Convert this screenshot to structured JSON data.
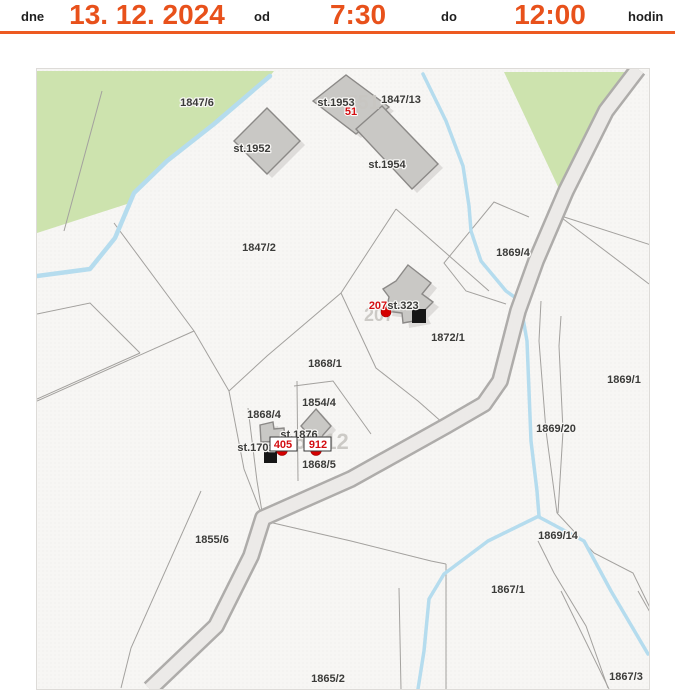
{
  "header": {
    "dne_label": "dne",
    "date": "13. 12. 2024",
    "od_label": "od",
    "time_from": "7:30",
    "do_label": "do",
    "time_to": "12:00",
    "hodin_label": "hodin"
  },
  "colors": {
    "accent_orange": "#e8511b",
    "header_text": "#1f1f1f",
    "forest_green": "#cde3ae",
    "water_blue": "#b5dcee",
    "road_casing": "#aeacaa",
    "road_fill": "#eceae8",
    "building_gray": "#c9c8c5",
    "building_black": "#161616",
    "marker_red": "#d40000",
    "label_dark": "#3b3b39",
    "watermark_gray": "#c8c6c2"
  },
  "map": {
    "parcel_labels": [
      {
        "t": "1847/6",
        "x": 160,
        "y": 37
      },
      {
        "t": "1847/13",
        "x": 364,
        "y": 34
      },
      {
        "t": "1847/2",
        "x": 222,
        "y": 182
      },
      {
        "t": "1869/4",
        "x": 476,
        "y": 187
      },
      {
        "t": "1872/1",
        "x": 411,
        "y": 272
      },
      {
        "t": "1868/1",
        "x": 288,
        "y": 298
      },
      {
        "t": "1869/1",
        "x": 587,
        "y": 314
      },
      {
        "t": "1854/4",
        "x": 282,
        "y": 337
      },
      {
        "t": "1868/4",
        "x": 227,
        "y": 349
      },
      {
        "t": "1869/20",
        "x": 519,
        "y": 363
      },
      {
        "t": "1868/5",
        "x": 282,
        "y": 399
      },
      {
        "t": "1869/14",
        "x": 521,
        "y": 470
      },
      {
        "t": "1855/6",
        "x": 175,
        "y": 474
      },
      {
        "t": "1867/1",
        "x": 471,
        "y": 524
      },
      {
        "t": "1865/2",
        "x": 291,
        "y": 613
      },
      {
        "t": "1867/3",
        "x": 589,
        "y": 611
      }
    ],
    "building_labels": [
      {
        "t": "st.1952",
        "x": 215,
        "y": 83
      },
      {
        "t": "st.1953",
        "x": 299,
        "y": 37
      },
      {
        "t": "st.1954",
        "x": 350,
        "y": 99
      },
      {
        "t": "st.323",
        "x": 366,
        "y": 240
      },
      {
        "t": "st.1876",
        "x": 262,
        "y": 369
      },
      {
        "t": "st.1701",
        "x": 219,
        "y": 382
      }
    ],
    "red_labels": [
      {
        "t": "51",
        "x": 314,
        "y": 46
      },
      {
        "t": "207",
        "x": 341,
        "y": 240
      }
    ],
    "boxed_labels": [
      {
        "t": "405",
        "bx": 233,
        "by": 368,
        "bw": 27,
        "bh": 14,
        "x": 246,
        "y": 379
      },
      {
        "t": "912",
        "bx": 267,
        "by": 368,
        "bw": 27,
        "bh": 14,
        "x": 281,
        "y": 379
      }
    ],
    "watermarks": [
      {
        "t": "E51",
        "x": 325,
        "y": 40,
        "size": 20
      },
      {
        "t": "207",
        "x": 342,
        "y": 252,
        "size": 18
      },
      {
        "t": "405 912",
        "x": 272,
        "y": 380,
        "size": 22
      }
    ],
    "markers": [
      {
        "x": 349,
        "y": 243,
        "r": 5
      },
      {
        "x": 245,
        "y": 381,
        "r": 5.5
      },
      {
        "x": 279,
        "y": 381,
        "r": 5.5
      }
    ]
  }
}
